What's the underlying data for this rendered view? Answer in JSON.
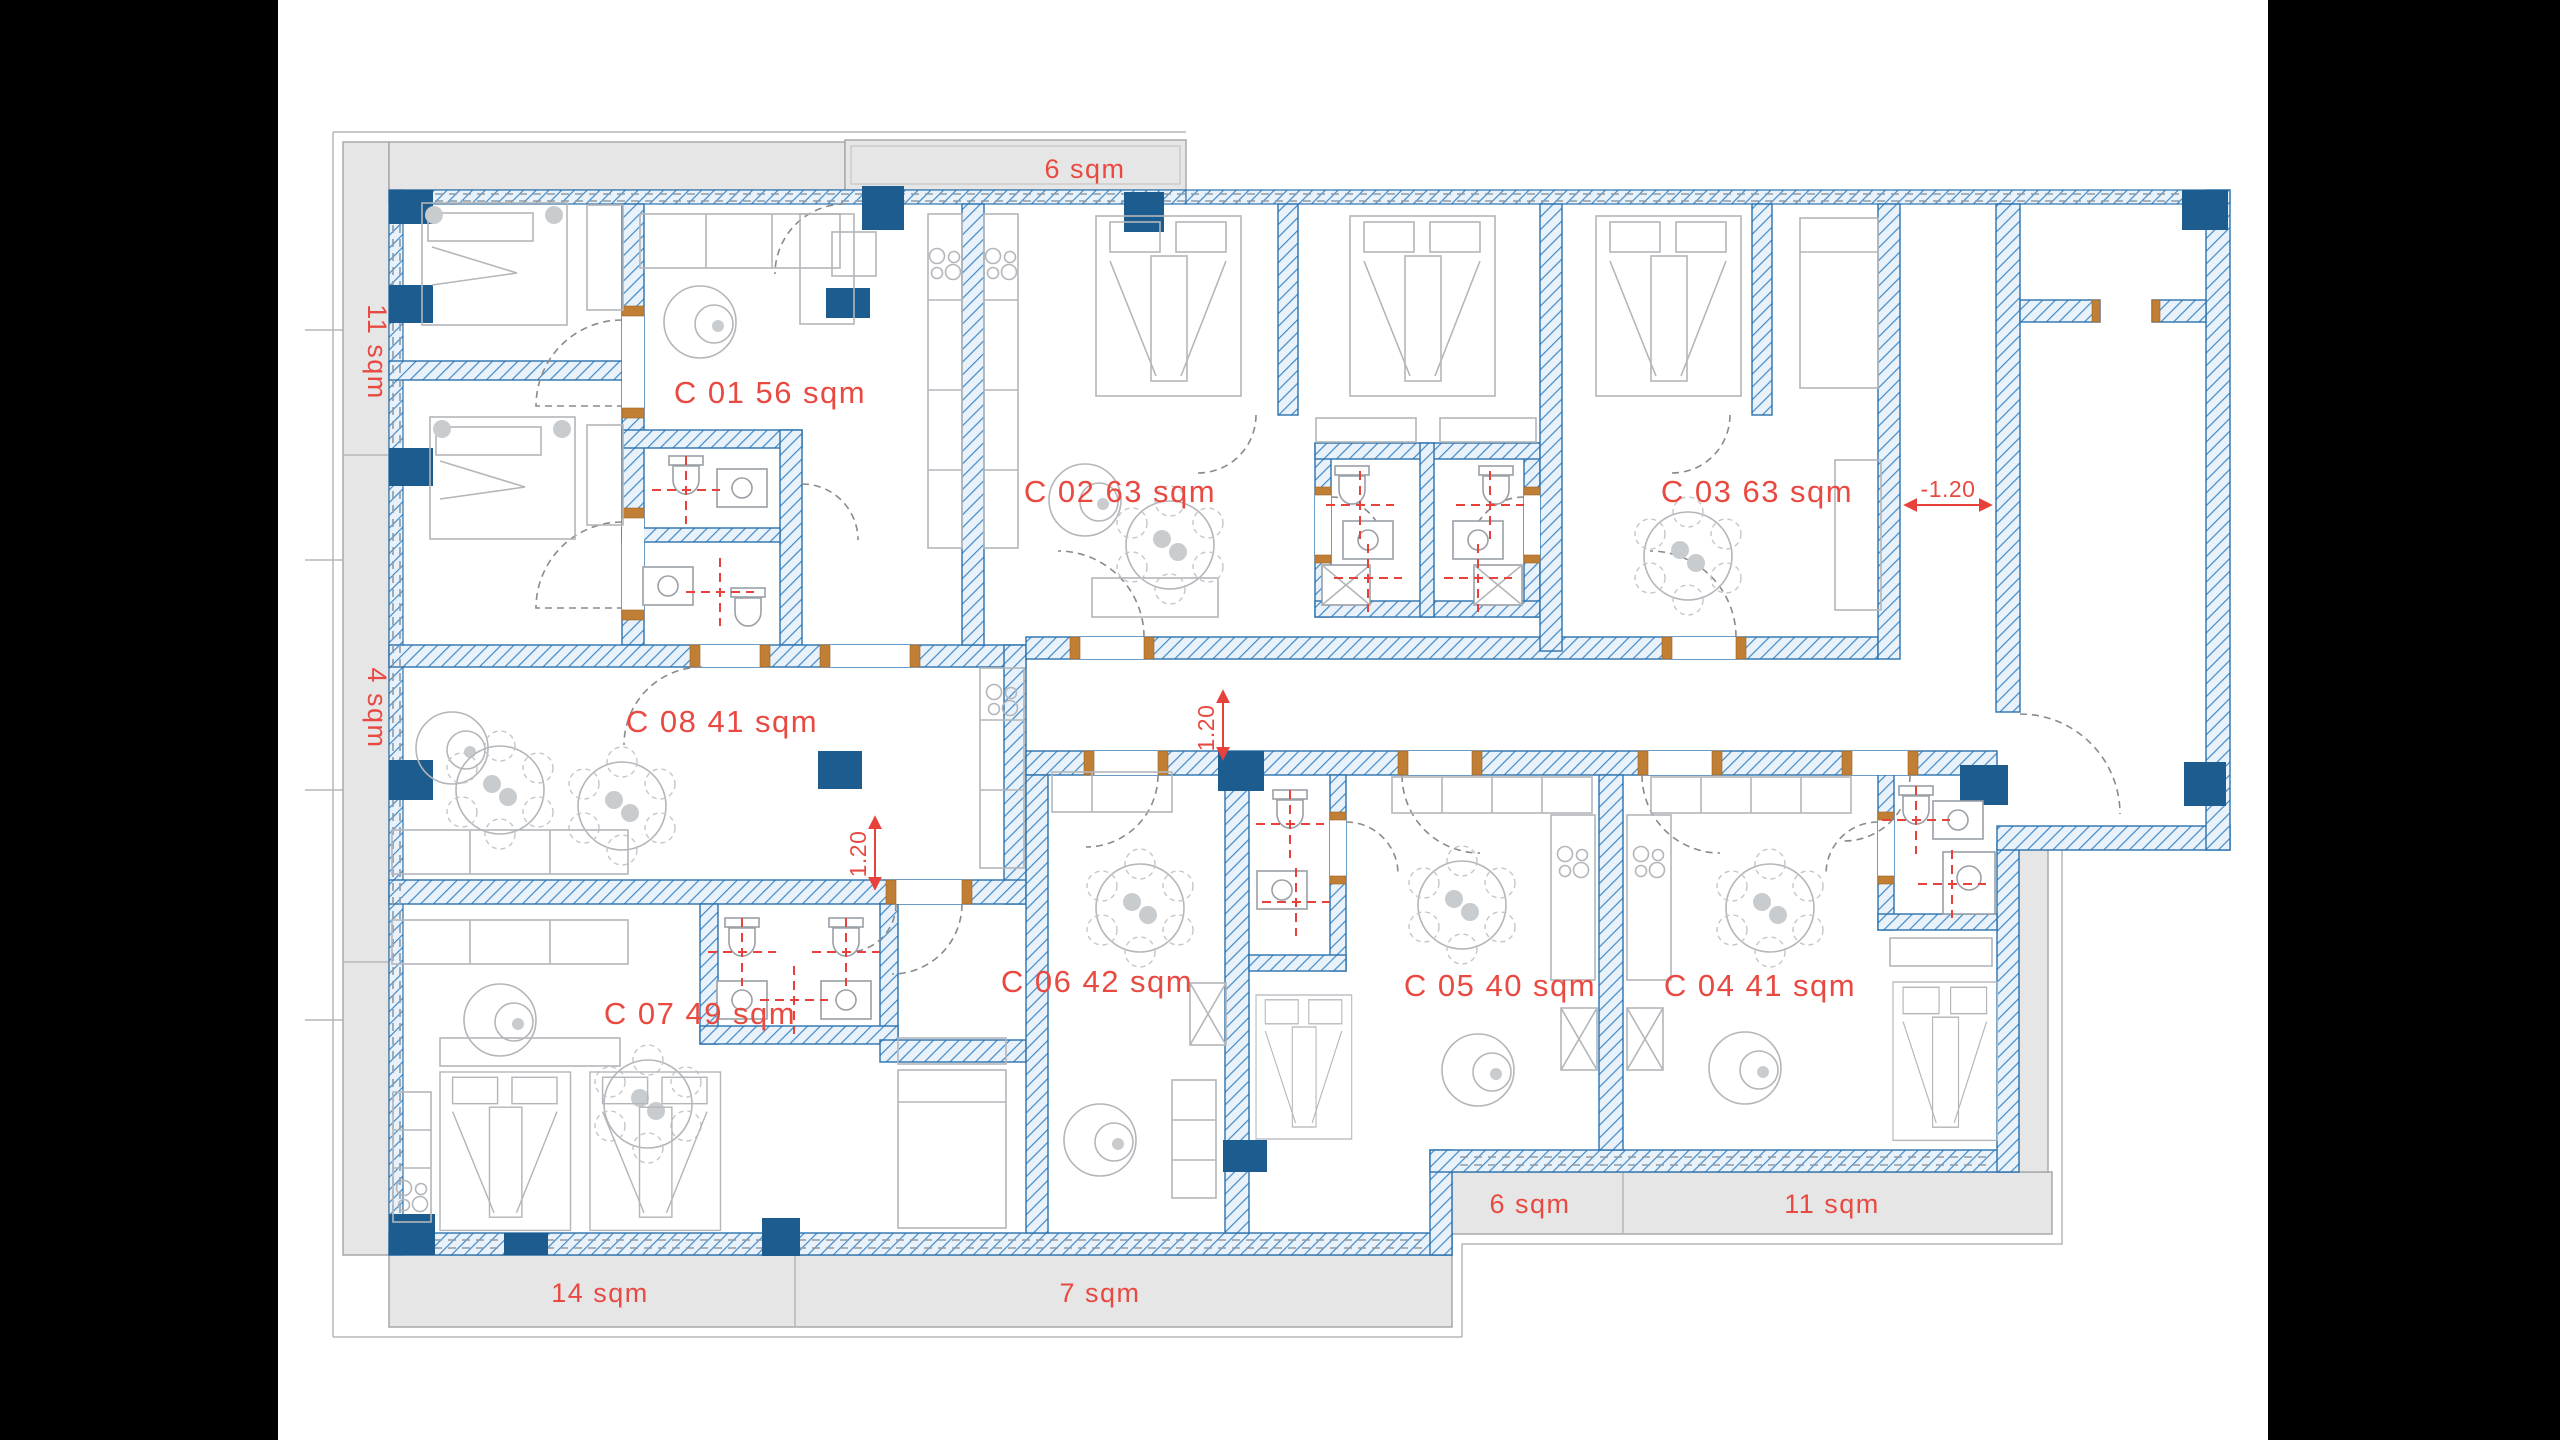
{
  "plan": {
    "type": "architectural-floor-plan",
    "units": [
      {
        "id": "C01",
        "label": "C 01 56 sqm"
      },
      {
        "id": "C02",
        "label": "C 02 63 sqm"
      },
      {
        "id": "C03",
        "label": "C 03 63 sqm"
      },
      {
        "id": "C04",
        "label": "C 04 41 sqm"
      },
      {
        "id": "C05",
        "label": "C 05 40 sqm"
      },
      {
        "id": "C06",
        "label": "C 06 42 sqm"
      },
      {
        "id": "C07",
        "label": "C 07 49 sqm"
      },
      {
        "id": "C08",
        "label": "C 08 41 sqm"
      }
    ],
    "balconies": [
      {
        "id": "top",
        "label": "6 sqm"
      },
      {
        "id": "left-upper",
        "label": "11 sqm"
      },
      {
        "id": "left-lower",
        "label": "4 sqm"
      },
      {
        "id": "bottom-left",
        "label": "14 sqm"
      },
      {
        "id": "bottom-center",
        "label": "7 sqm"
      },
      {
        "id": "bottom-right-small",
        "label": "6 sqm"
      },
      {
        "id": "bottom-right-large",
        "label": "11 sqm"
      }
    ],
    "dimensions": [
      {
        "id": "entry-level",
        "label": "-1.20"
      },
      {
        "id": "corridor-width",
        "label": "1.20"
      },
      {
        "id": "passage-width",
        "label": "1.20"
      }
    ],
    "colors": {
      "wall_outline": "#2b72ad",
      "wall_hatch": "#4189c7",
      "wall_fill": "#e9f2fb",
      "column_navy": "#1c5c8e",
      "door_frame_orange": "#c17f35",
      "label_red": "#e84a42",
      "terrace_gray": "#e6e6e6",
      "furniture_gray": "#b3b6ba",
      "background": "#ffffff",
      "side_bars": "#000000"
    }
  }
}
